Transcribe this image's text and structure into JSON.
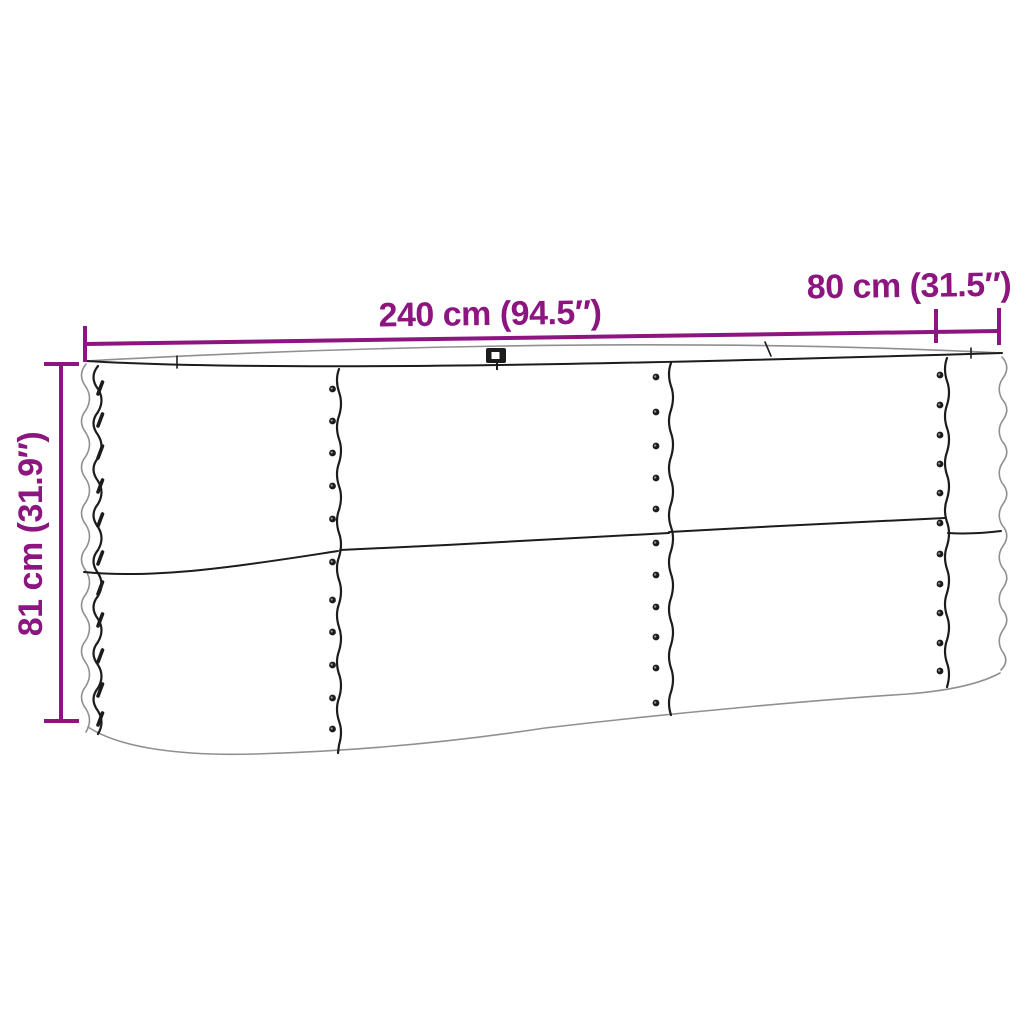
{
  "dimensions": {
    "length": "240 cm (94.5″)",
    "width": "80 cm (31.5″)",
    "height": "81 cm (31.9″)"
  },
  "colors": {
    "dimension_accent": "#8C1580",
    "outline": "#1c1c1c",
    "soft_outline": "#909090",
    "background": "#ffffff"
  },
  "rivets": {
    "seams": [
      {
        "x": 332.5,
        "ys": [
          389,
          421,
          453,
          486,
          519,
          562,
          600,
          632,
          665,
          698,
          729
        ]
      },
      {
        "x": 656,
        "ys": [
          377,
          412,
          446,
          478,
          509,
          543,
          575,
          607,
          637,
          668,
          703
        ]
      },
      {
        "x": 940,
        "ys": [
          375,
          405,
          435,
          464,
          493,
          523,
          554,
          584,
          613,
          643,
          671
        ]
      }
    ],
    "left_edge": {
      "x": 100,
      "ys": [
        388,
        420,
        452,
        486,
        520,
        558,
        588,
        620,
        656,
        690,
        719
      ]
    }
  }
}
